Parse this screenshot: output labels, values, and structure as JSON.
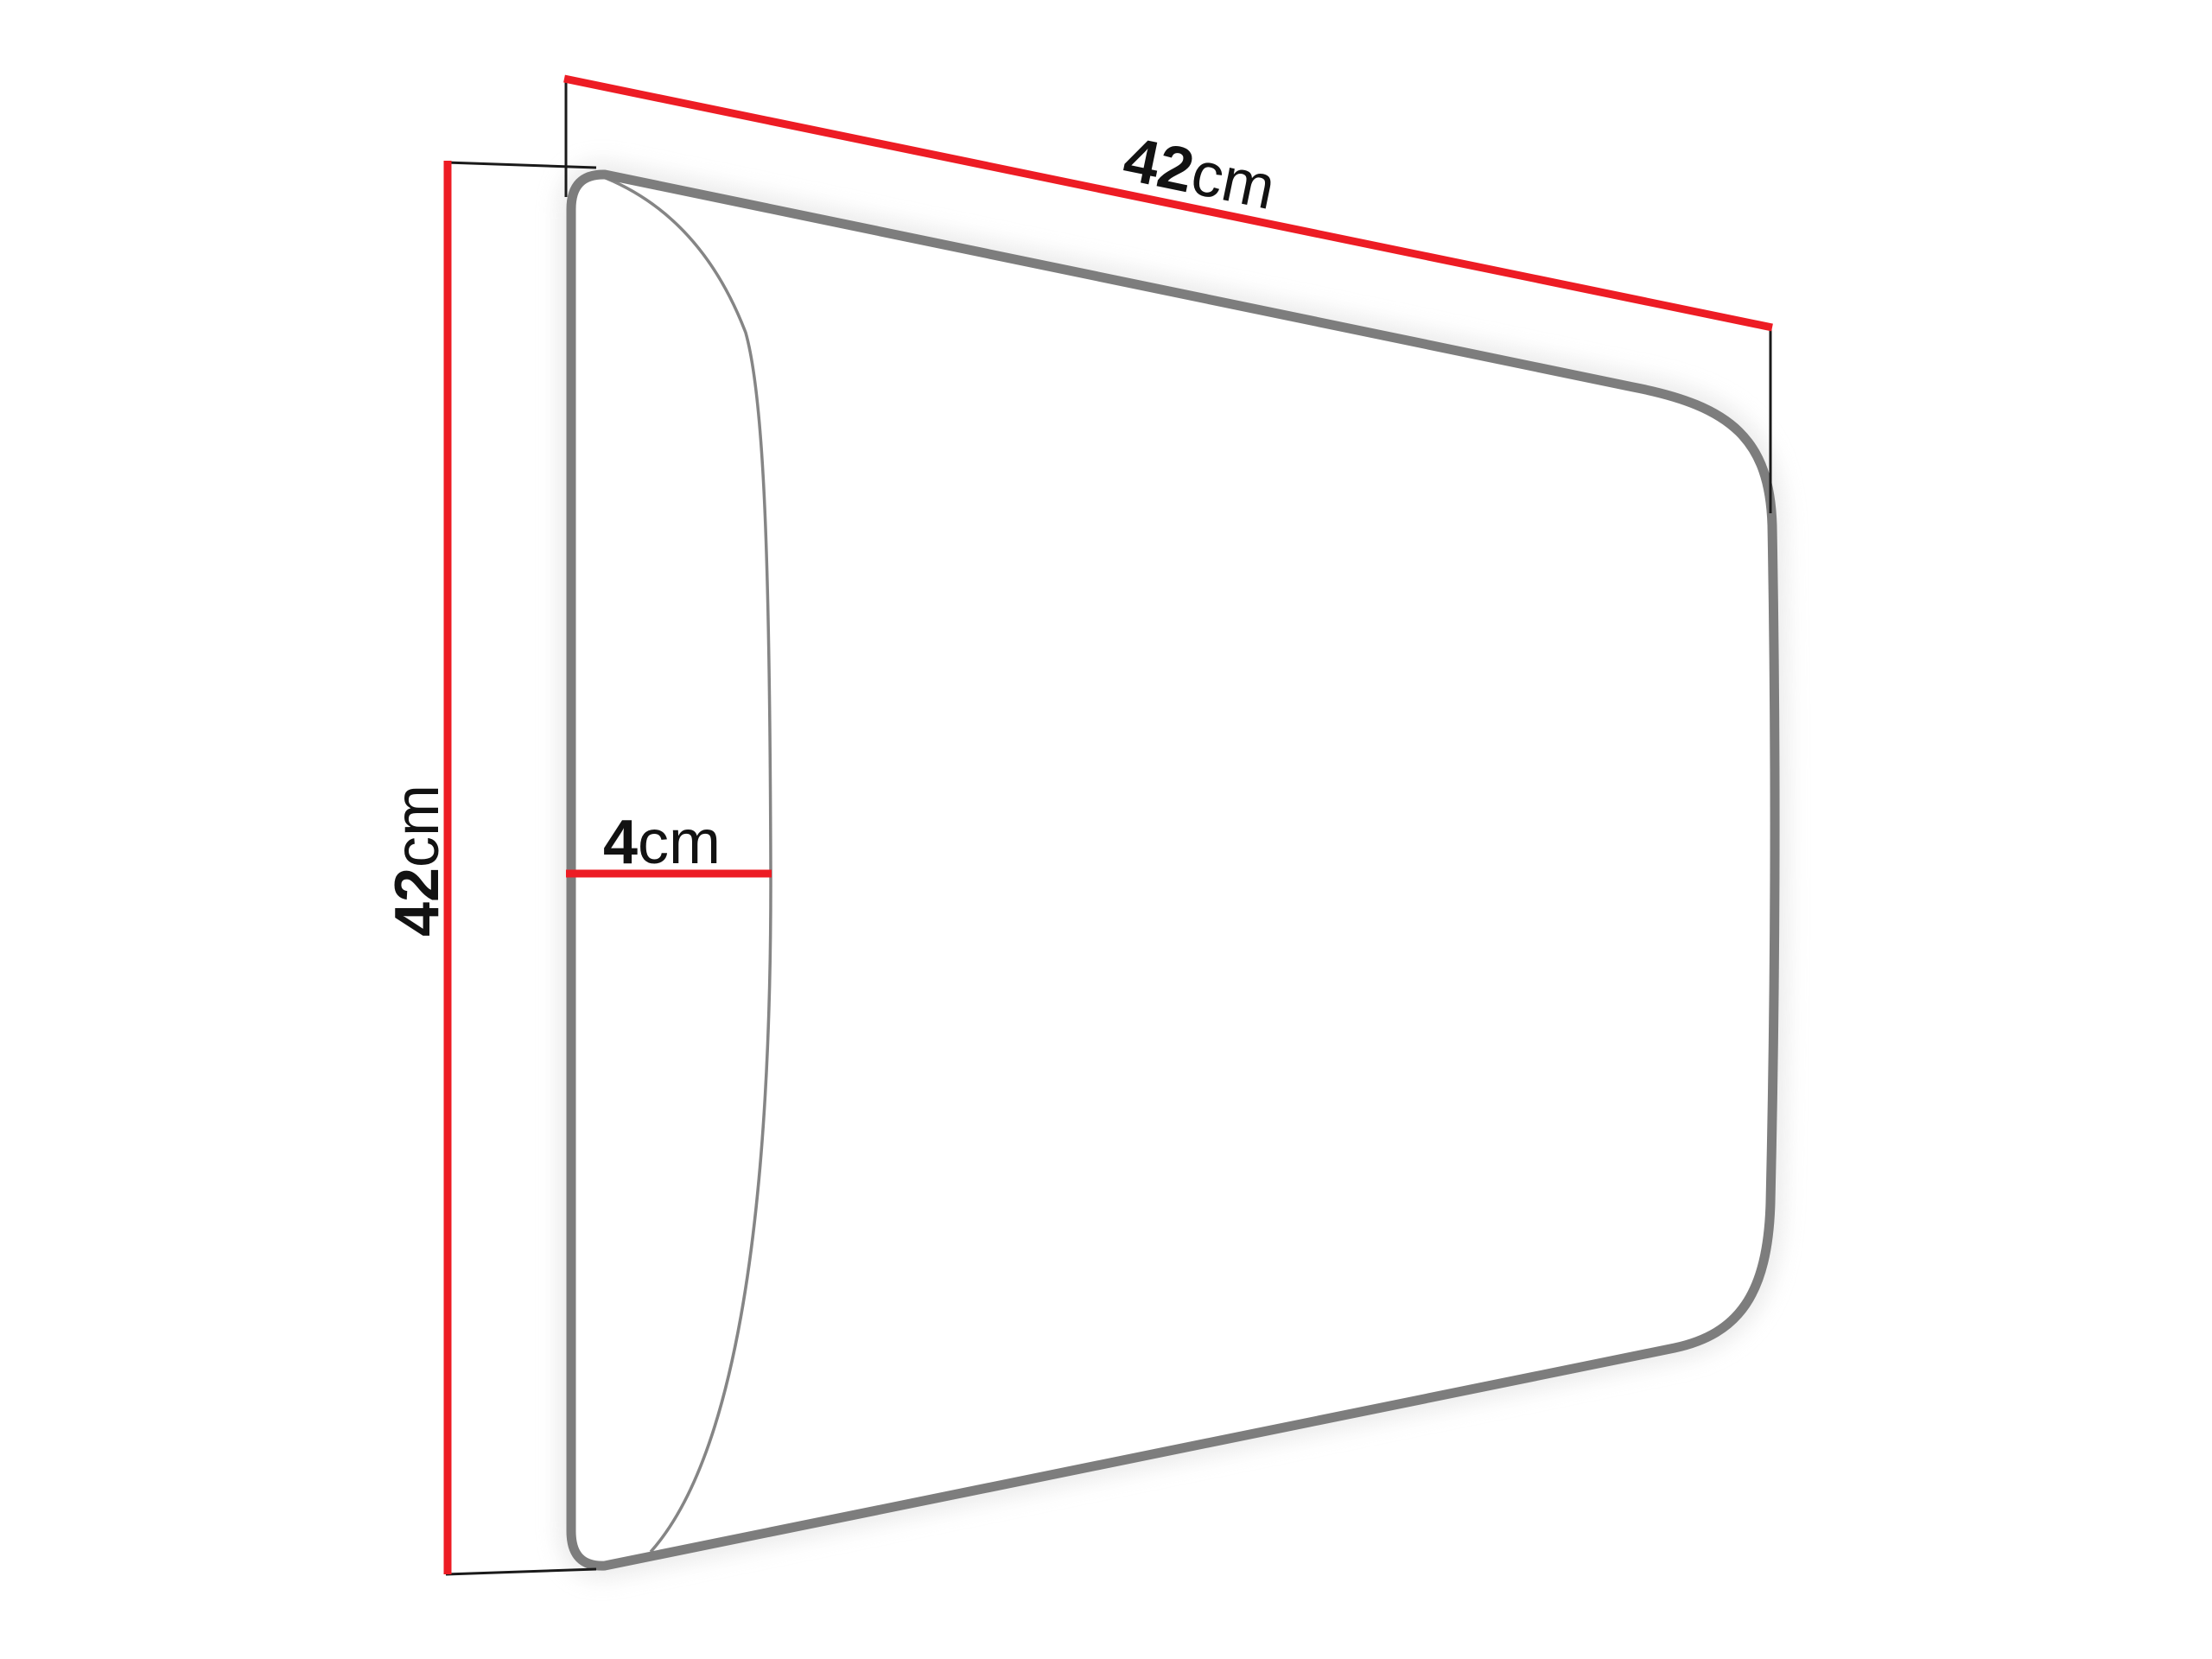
{
  "diagram": {
    "dimensions": {
      "width": {
        "value": "42",
        "unit": "cm"
      },
      "height": {
        "value": "42",
        "unit": "cm"
      },
      "depth": {
        "value": "4",
        "unit": "cm"
      }
    },
    "colors": {
      "dimension_line": "#ed1c24",
      "panel_outline": "#7d7d7d",
      "front_edge": "#858585",
      "extension_line": "#1a1a1a",
      "panel_fill": "#ffffff",
      "glow": "#dedede",
      "text": "#121212",
      "background": "#ffffff"
    }
  }
}
